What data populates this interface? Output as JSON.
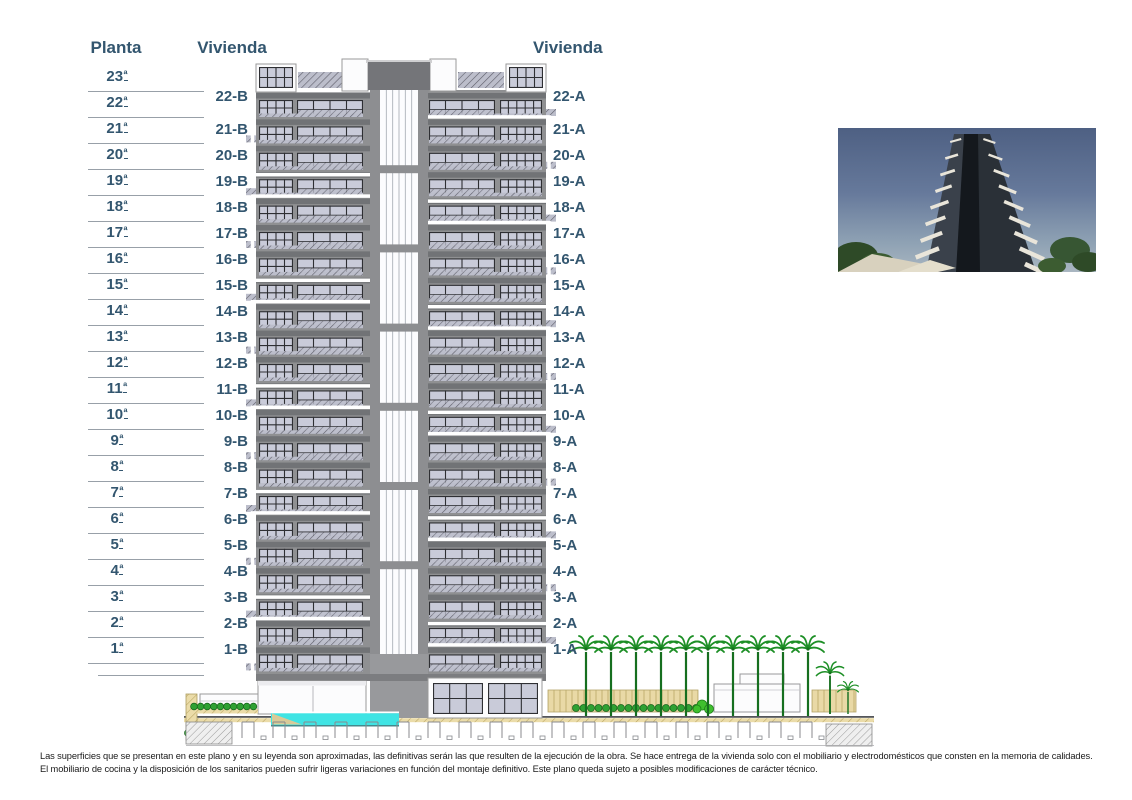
{
  "colors": {
    "label_text": "#33566F",
    "facade_gray": "#8F9092",
    "window_glass": "#C9CBD9",
    "pool_cyan": "#3FE4E4",
    "palm_green": "#1D8F26",
    "photo_sky": "#66799B"
  },
  "table": {
    "planta_header": "Planta",
    "vivienda_left_header": "Vivienda",
    "vivienda_right_header": "Vivienda",
    "plantas": [
      "23ª",
      "22ª",
      "21ª",
      "20ª",
      "19ª",
      "18ª",
      "17ª",
      "16ª",
      "15ª",
      "14ª",
      "13ª",
      "12ª",
      "11ª",
      "10ª",
      "9ª",
      "8ª",
      "7ª",
      "6ª",
      "5ª",
      "4ª",
      "3ª",
      "2ª",
      "1ª"
    ],
    "viviendas_b": [
      "22-B",
      "21-B",
      "20-B",
      "19-B",
      "18-B",
      "17-B",
      "16-B",
      "15-B",
      "14-B",
      "13-B",
      "12-B",
      "11-B",
      "10-B",
      "9-B",
      "8-B",
      "7-B",
      "6-B",
      "5-B",
      "4-B",
      "3-B",
      "2-B",
      "1-B"
    ],
    "viviendas_a": [
      "22-A",
      "21-A",
      "20-A",
      "19-A",
      "18-A",
      "17-A",
      "16-A",
      "15-A",
      "14-A",
      "13-A",
      "12-A",
      "11-A",
      "10-A",
      "9-A",
      "8-A",
      "7-A",
      "6-A",
      "5-A",
      "4-A",
      "3-A",
      "2-A",
      "1-A"
    ]
  },
  "disclaimer": {
    "line1": "Las superficies que se presentan en este plano y en su leyenda son aproximadas, las definitivas serán las que resulten de la ejecución de la obra. Se hace entrega de la vivienda solo con el mobiliario y electrodomésticos que consten en la memoria de calidades.",
    "line2": "El mobiliario de cocina y la disposición de los sanitarios pueden sufrir ligeras variaciones en función del montaje definitivo. Este plano queda sujeto a posibles modificaciones de carácter técnico."
  }
}
